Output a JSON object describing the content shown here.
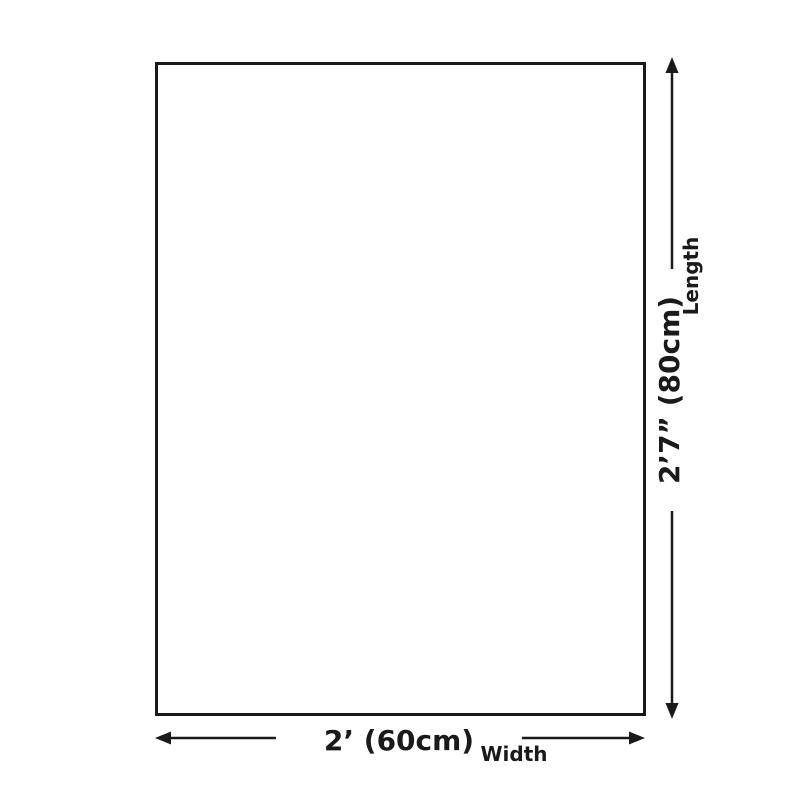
{
  "diagram": {
    "length": {
      "value": "2’7” (80cm)",
      "label": "Length"
    },
    "width": {
      "value": "2’ (60cm)",
      "label": "Width"
    },
    "colors": {
      "line": "#1a1a1a",
      "canvas_fill": "#ffffff",
      "background": "#ffffff"
    }
  }
}
